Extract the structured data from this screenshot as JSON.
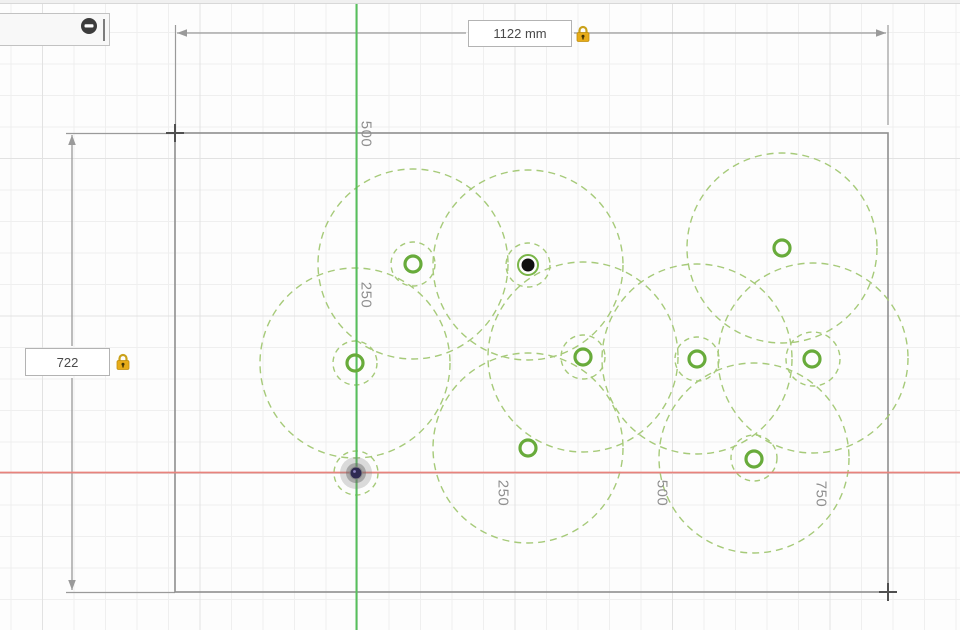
{
  "dimensions": {
    "width": {
      "value": "1122 mm",
      "locked": true
    },
    "height": {
      "value": "722",
      "locked": true
    }
  },
  "ruler_labels": [
    {
      "text": "500",
      "x": 366,
      "y": 134
    },
    {
      "text": "250",
      "x": 366,
      "y": 295
    },
    {
      "text": "250",
      "x": 503,
      "y": 493
    },
    {
      "text": "500",
      "x": 662,
      "y": 493
    },
    {
      "text": "750",
      "x": 821,
      "y": 494
    }
  ],
  "sketch": {
    "rectangle": {
      "x1": 175,
      "y1": 133,
      "x2": 888,
      "y2": 592
    },
    "axes": {
      "vertical_x": 356.5,
      "horizontal_y": 472.5
    },
    "large_construction_circles": [
      {
        "cx": 413,
        "cy": 264,
        "r": 95
      },
      {
        "cx": 528,
        "cy": 265,
        "r": 95
      },
      {
        "cx": 355,
        "cy": 363,
        "r": 95
      },
      {
        "cx": 583,
        "cy": 357,
        "r": 95
      },
      {
        "cx": 697,
        "cy": 359,
        "r": 95
      },
      {
        "cx": 813,
        "cy": 358,
        "r": 95
      },
      {
        "cx": 782,
        "cy": 248,
        "r": 95
      },
      {
        "cx": 528,
        "cy": 448,
        "r": 95
      },
      {
        "cx": 754,
        "cy": 458,
        "r": 95
      }
    ],
    "small_construction_circles": [
      {
        "cx": 413,
        "cy": 264,
        "r": 22
      },
      {
        "cx": 528,
        "cy": 265,
        "r": 22
      },
      {
        "cx": 355,
        "cy": 363,
        "r": 22
      },
      {
        "cx": 583,
        "cy": 357,
        "r": 22
      },
      {
        "cx": 697,
        "cy": 359,
        "r": 22
      },
      {
        "cx": 813,
        "cy": 359,
        "r": 27
      },
      {
        "cx": 754,
        "cy": 458,
        "r": 23
      },
      {
        "cx": 356,
        "cy": 473,
        "r": 22
      }
    ],
    "hole_points": [
      {
        "cx": 413,
        "cy": 264
      },
      {
        "cx": 355,
        "cy": 363
      },
      {
        "cx": 583,
        "cy": 357
      },
      {
        "cx": 697,
        "cy": 359
      },
      {
        "cx": 812,
        "cy": 359
      },
      {
        "cx": 782,
        "cy": 248
      },
      {
        "cx": 528,
        "cy": 448
      },
      {
        "cx": 754,
        "cy": 459
      }
    ],
    "selected_point": {
      "cx": 528,
      "cy": 265
    },
    "origin_point": {
      "cx": 356,
      "cy": 473
    },
    "dim_top": {
      "line_y": 33,
      "ext_top_y": 25,
      "gap_x1": 466,
      "gap_x2": 574
    },
    "dim_left": {
      "line_x": 72,
      "ext_left_x": 66,
      "gap_y1": 346,
      "gap_y2": 378
    }
  },
  "colors": {
    "construction_green": "#a6ca79",
    "entity_green": "#68ab3b",
    "axis_green": "#56c05c",
    "axis_red": "#e8837d",
    "dim_gray": "#9a9a9a",
    "corner_marker": "#4f4f4f",
    "lock_gold": "#e7ac19",
    "lock_gold_dark": "#c18f0e"
  }
}
